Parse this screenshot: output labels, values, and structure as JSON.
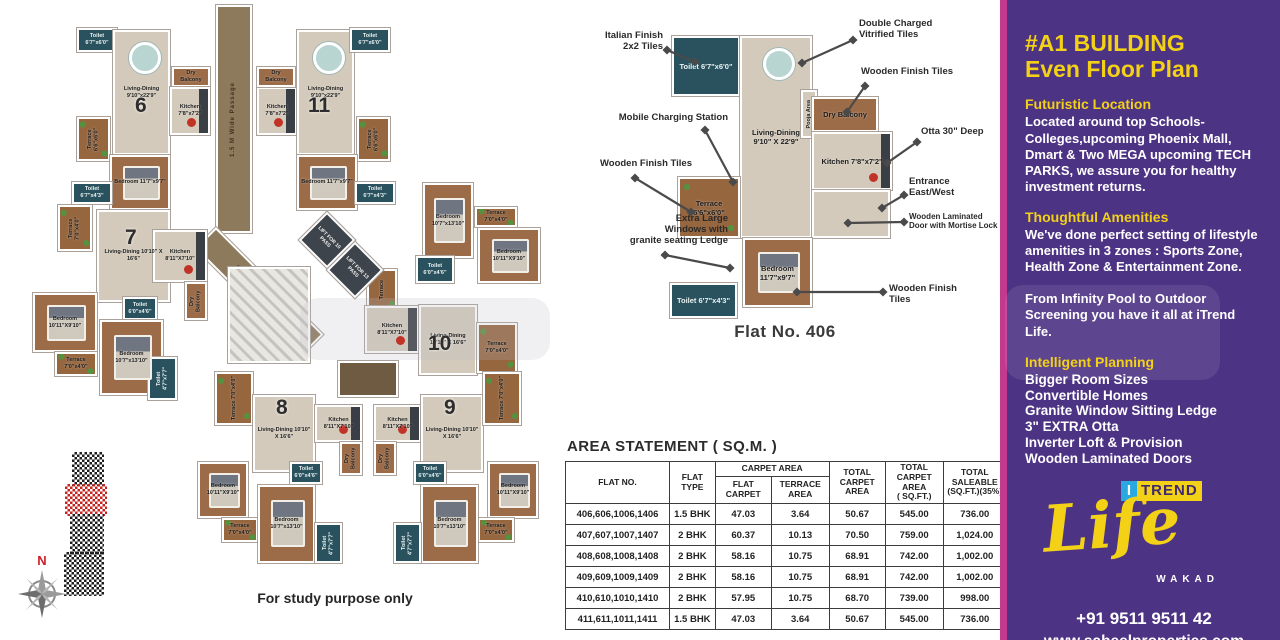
{
  "left_plan": {
    "disclaimer": "For study purpose only",
    "compass_n": "N",
    "passages": [
      {
        "n": "passage-vertical",
        "l": "1.5 M Wide Passage",
        "x": 196,
        "y": 0,
        "w": 36,
        "h": 228,
        "vert": true
      },
      {
        "n": "passage-diagonal",
        "l": "2 M Wide Passage",
        "x": 196,
        "y": 222,
        "w": 152,
        "h": 30,
        "rot": 45
      }
    ],
    "lobby": {
      "n": "lift-lobby",
      "x": 318,
      "y": 356,
      "w": 60,
      "h": 36
    },
    "stairs": {
      "n": "stairs",
      "x": 208,
      "y": 262,
      "w": 82,
      "h": 96
    },
    "lifts": [
      {
        "n": "lift-10-pass",
        "l": "LIFT FOR 10 PASS",
        "x": 287,
        "y": 215,
        "w": 40,
        "h": 40
      },
      {
        "n": "lift-13-pass",
        "l": "LIFT FOR 13 PASS",
        "x": 315,
        "y": 245,
        "w": 40,
        "h": 40
      }
    ],
    "flat_numbers": [
      {
        "num": "6",
        "x": 115,
        "y": 90
      },
      {
        "num": "11",
        "x": 288,
        "y": 90
      },
      {
        "num": "7",
        "x": 105,
        "y": 222
      },
      {
        "num": "10",
        "x": 408,
        "y": 328
      },
      {
        "num": "8",
        "x": 256,
        "y": 392
      },
      {
        "num": "9",
        "x": 424,
        "y": 392
      }
    ],
    "rooms": [
      {
        "n": "f6-toilet-top",
        "t": "toilet",
        "l": "Toilet 6'7\"x6'0\"",
        "x": 57,
        "y": 23,
        "w": 40,
        "h": 24
      },
      {
        "n": "f6-living",
        "t": "floor",
        "l": "Living-Dining 9'10\"x22'9\"",
        "x": 93,
        "y": 25,
        "w": 57,
        "h": 125,
        "furn": "table"
      },
      {
        "n": "f6-dry-balcony",
        "t": "wood",
        "l": "Dry Balcony",
        "x": 152,
        "y": 62,
        "w": 38,
        "h": 20
      },
      {
        "n": "f6-kitchen",
        "t": "kitchen",
        "l": "Kitchen 7'8\"x7'2\"",
        "x": 150,
        "y": 82,
        "w": 40,
        "h": 48,
        "furn": "stove"
      },
      {
        "n": "f6-terrace",
        "t": "terr",
        "l": "Terrace 6'6\"x6'0\"",
        "x": 57,
        "y": 112,
        "w": 33,
        "h": 44,
        "vert": true
      },
      {
        "n": "f6-bedroom",
        "t": "wood",
        "l": "Bedroom 11'7\"x9'7\"",
        "x": 90,
        "y": 150,
        "w": 60,
        "h": 55,
        "furn": "bed"
      },
      {
        "n": "f6-toilet-bottom",
        "t": "toilet",
        "l": "Toilet 6'7\"x4'3\"",
        "x": 52,
        "y": 177,
        "w": 40,
        "h": 22
      },
      {
        "n": "f11-kitchen",
        "t": "kitchen",
        "l": "Kitchen 7'8\"x7'2\"",
        "x": 237,
        "y": 82,
        "w": 40,
        "h": 48,
        "furn": "stove"
      },
      {
        "n": "f11-dry-balcony",
        "t": "wood",
        "l": "Dry Balcony",
        "x": 237,
        "y": 62,
        "w": 38,
        "h": 20
      },
      {
        "n": "f11-living",
        "t": "floor",
        "l": "Living-Dining 9'10\"x22'9\"",
        "x": 277,
        "y": 25,
        "w": 57,
        "h": 125,
        "furn": "table"
      },
      {
        "n": "f11-toilet-top",
        "t": "toilet",
        "l": "Toilet 6'7\"x6'0\"",
        "x": 330,
        "y": 23,
        "w": 40,
        "h": 24
      },
      {
        "n": "f11-terrace",
        "t": "terr",
        "l": "Terrace 6'6\"x6'0\"",
        "x": 337,
        "y": 112,
        "w": 33,
        "h": 44,
        "vert": true
      },
      {
        "n": "f11-bedroom",
        "t": "wood",
        "l": "Bedroom 11'7\"x9'7\"",
        "x": 277,
        "y": 150,
        "w": 60,
        "h": 55,
        "furn": "bed"
      },
      {
        "n": "f11-toilet-bottom",
        "t": "toilet",
        "l": "Toilet 6'7\"x4'3\"",
        "x": 335,
        "y": 177,
        "w": 40,
        "h": 22
      },
      {
        "n": "f7-terrace-top",
        "t": "terr",
        "l": "Terrace 7'0\"x4'0\"",
        "x": 38,
        "y": 200,
        "w": 34,
        "h": 46,
        "vert": true
      },
      {
        "n": "f7-living",
        "t": "floor",
        "l": "Living-Dining 10'10\" X 16'6\"",
        "x": 77,
        "y": 205,
        "w": 73,
        "h": 92
      },
      {
        "n": "f7-kitchen",
        "t": "kitchen",
        "l": "Kitchen 8'11\"X7'10\"",
        "x": 133,
        "y": 225,
        "w": 54,
        "h": 52,
        "furn": "stove"
      },
      {
        "n": "f7-dry-balcony",
        "t": "wood",
        "l": "Dry Balcony",
        "x": 165,
        "y": 277,
        "w": 22,
        "h": 38,
        "vert": true
      },
      {
        "n": "f7-toilet-hall",
        "t": "toilet",
        "l": "Toilet 6'0\"x4'6\"",
        "x": 103,
        "y": 292,
        "w": 34,
        "h": 23
      },
      {
        "n": "f7-bedroom-left",
        "t": "wood",
        "l": "Bedroom 10'11\"X9'10\"",
        "x": 13,
        "y": 288,
        "w": 64,
        "h": 59,
        "furn": "bed"
      },
      {
        "n": "f7-terrace-left",
        "t": "terr",
        "l": "Terrace 7'0\"x4'0\"",
        "x": 35,
        "y": 347,
        "w": 42,
        "h": 24
      },
      {
        "n": "f7-bedroom-bottom",
        "t": "wood",
        "l": "Bedroom 10'7\"x13'10\"",
        "x": 80,
        "y": 315,
        "w": 63,
        "h": 75,
        "furn": "bed"
      },
      {
        "n": "f7-toilet-bottom",
        "t": "toilet",
        "l": "Toilet 4'7\"x7'7\"",
        "x": 128,
        "y": 352,
        "w": 29,
        "h": 43,
        "vert": true
      },
      {
        "n": "f10-bedroom-top",
        "t": "wood",
        "l": "Bedroom 10'7\"x13'10\"",
        "x": 403,
        "y": 178,
        "w": 50,
        "h": 75,
        "furn": "bed"
      },
      {
        "n": "f10-terrace-right",
        "t": "terr",
        "l": "Terrace 7'0\"x4'0\"",
        "x": 455,
        "y": 202,
        "w": 42,
        "h": 20
      },
      {
        "n": "f10-bedroom-right",
        "t": "wood",
        "l": "Bedroom 10'11\"X9'10\"",
        "x": 458,
        "y": 223,
        "w": 62,
        "h": 55,
        "furn": "bed"
      },
      {
        "n": "f10-toilet",
        "t": "toilet",
        "l": "Toilet 6'0\"x4'6\"",
        "x": 396,
        "y": 251,
        "w": 38,
        "h": 27
      },
      {
        "n": "f10-terrace-left",
        "t": "terr",
        "l": "Terrace",
        "x": 347,
        "y": 264,
        "w": 30,
        "h": 42,
        "vert": true
      },
      {
        "n": "f10-kitchen",
        "t": "kitchen",
        "l": "Kitchen 8'11\"X7'10\"",
        "x": 345,
        "y": 301,
        "w": 54,
        "h": 47,
        "furn": "stove"
      },
      {
        "n": "f10-living",
        "t": "floor",
        "l": "Living-Dining 10'10\" X 16'6\"",
        "x": 399,
        "y": 300,
        "w": 58,
        "h": 70
      },
      {
        "n": "f10-terrace-bottom",
        "t": "terr",
        "l": "Terrace 7'0\"x4'0\"",
        "x": 457,
        "y": 318,
        "w": 40,
        "h": 50
      },
      {
        "n": "f8-terrace-top",
        "t": "terr",
        "l": "Terrace 7'0\"x4'0\"",
        "x": 195,
        "y": 367,
        "w": 38,
        "h": 53,
        "vert": true
      },
      {
        "n": "f8-living",
        "t": "floor",
        "l": "Living-Dining 10'10\" X 16'6\"",
        "x": 233,
        "y": 390,
        "w": 62,
        "h": 77
      },
      {
        "n": "f8-kitchen",
        "t": "kitchen",
        "l": "Kitchen 8'11\"X7'10\"",
        "x": 295,
        "y": 400,
        "w": 47,
        "h": 37,
        "furn": "stove"
      },
      {
        "n": "f8-dry-balcony",
        "t": "wood",
        "l": "Dry Balcony",
        "x": 320,
        "y": 437,
        "w": 22,
        "h": 33,
        "vert": true
      },
      {
        "n": "f8-toilet-hall",
        "t": "toilet",
        "l": "Toilet 6'0\"x4'6\"",
        "x": 270,
        "y": 457,
        "w": 32,
        "h": 22
      },
      {
        "n": "f8-bedroom-left",
        "t": "wood",
        "l": "Bedroom 10'11\"X9'10\"",
        "x": 178,
        "y": 457,
        "w": 50,
        "h": 56,
        "furn": "bed"
      },
      {
        "n": "f8-terrace-bottom",
        "t": "terr",
        "l": "Terrace 7'0\"x4'0\"",
        "x": 202,
        "y": 513,
        "w": 36,
        "h": 24
      },
      {
        "n": "f8-bedroom-bottom",
        "t": "wood",
        "l": "Bedroom 10'7\"x13'10\"",
        "x": 238,
        "y": 480,
        "w": 57,
        "h": 78,
        "furn": "bed"
      },
      {
        "n": "f8-toilet-bottom",
        "t": "toilet",
        "l": "Toilet 4'7\"x7'7\"",
        "x": 295,
        "y": 518,
        "w": 27,
        "h": 40,
        "vert": true
      },
      {
        "n": "f9-kitchen",
        "t": "kitchen",
        "l": "Kitchen 8'11\"X7'10\"",
        "x": 354,
        "y": 400,
        "w": 47,
        "h": 37,
        "furn": "stove"
      },
      {
        "n": "f9-dry-balcony",
        "t": "wood",
        "l": "Dry Balcony",
        "x": 354,
        "y": 437,
        "w": 22,
        "h": 33,
        "vert": true
      },
      {
        "n": "f9-living",
        "t": "floor",
        "l": "Living-Dining 10'10\" X 16'6\"",
        "x": 401,
        "y": 390,
        "w": 62,
        "h": 77
      },
      {
        "n": "f9-terrace-top",
        "t": "terr",
        "l": "Terrace 7'0\"x4'0\"",
        "x": 463,
        "y": 367,
        "w": 38,
        "h": 53,
        "vert": true
      },
      {
        "n": "f9-toilet-hall",
        "t": "toilet",
        "l": "Toilet 6'0\"x4'6\"",
        "x": 394,
        "y": 457,
        "w": 32,
        "h": 22
      },
      {
        "n": "f9-bedroom-right",
        "t": "wood",
        "l": "Bedroom 10'11\"X9'10\"",
        "x": 468,
        "y": 457,
        "w": 50,
        "h": 56,
        "furn": "bed"
      },
      {
        "n": "f9-terrace-bottom",
        "t": "terr",
        "l": "Terrace 7'0\"x4'0\"",
        "x": 458,
        "y": 513,
        "w": 36,
        "h": 24
      },
      {
        "n": "f9-bedroom-bottom",
        "t": "wood",
        "l": "Bedroom 10'7\"x13'10\"",
        "x": 401,
        "y": 480,
        "w": 57,
        "h": 78,
        "furn": "bed"
      },
      {
        "n": "f9-toilet-bottom",
        "t": "toilet",
        "l": "Toilet 4'7\"x7'7\"",
        "x": 374,
        "y": 518,
        "w": 27,
        "h": 40,
        "vert": true
      }
    ]
  },
  "detail_plan": {
    "caption": "Flat No. 406",
    "rooms": [
      {
        "n": "d-toilet-top",
        "t": "toilet",
        "l": "Toilet 6'7\"x6'0\"",
        "x": 107,
        "y": 36,
        "w": 68,
        "h": 60,
        "big": true
      },
      {
        "n": "d-living",
        "t": "floor",
        "l": "Living-Dining 9'10\" X 22'9\"",
        "x": 175,
        "y": 36,
        "w": 72,
        "h": 202,
        "big": true,
        "furn": "table"
      },
      {
        "n": "d-pooja",
        "t": "floor",
        "l": "Pooja Area",
        "x": 236,
        "y": 90,
        "w": 16,
        "h": 48,
        "vert": true
      },
      {
        "n": "d-dry-balcony",
        "t": "wood",
        "l": "Dry Balcony",
        "x": 247,
        "y": 97,
        "w": 66,
        "h": 35,
        "big": true
      },
      {
        "n": "d-kitchen",
        "t": "kitchen",
        "l": "Kitchen 7'8\"x7'2\"",
        "x": 247,
        "y": 132,
        "w": 80,
        "h": 58,
        "big": true,
        "furn": "stove"
      },
      {
        "n": "d-entry-hall",
        "t": "floor",
        "l": "",
        "x": 247,
        "y": 190,
        "w": 78,
        "h": 48
      },
      {
        "n": "d-terrace",
        "t": "terr",
        "l": "Terrace 6'6\"x6'0\"",
        "x": 113,
        "y": 177,
        "w": 62,
        "h": 61,
        "big": true
      },
      {
        "n": "d-bedroom",
        "t": "wood",
        "l": "Bedroom 11'7\"x9'7\"",
        "x": 178,
        "y": 238,
        "w": 69,
        "h": 69,
        "big": true,
        "furn": "bed"
      },
      {
        "n": "d-toilet-bottom",
        "t": "toilet",
        "l": "Toilet 6'7\"x4'3\"",
        "x": 105,
        "y": 283,
        "w": 67,
        "h": 35,
        "big": true
      }
    ],
    "annotations": [
      {
        "text": "Italian Finish\n2x2 Tiles",
        "side": "L",
        "bx": 18,
        "by": 30,
        "bw": 80,
        "ax": 102,
        "ay": 50,
        "tx": 130,
        "ty": 62
      },
      {
        "text": "Mobile Charging Station",
        "side": "L",
        "bx": 38,
        "by": 112,
        "bw": 125,
        "ax": 140,
        "ay": 130,
        "tx": 168,
        "ty": 182
      },
      {
        "text": "Wooden Finish Tiles",
        "side": "L",
        "bx": 15,
        "by": 158,
        "bw": 112,
        "ax": 70,
        "ay": 178,
        "tx": 126,
        "ty": 212
      },
      {
        "text": "Extra Large\nWindows with\ngranite seating Ledge",
        "side": "L",
        "bx": 15,
        "by": 213,
        "bw": 148,
        "ax": 100,
        "ay": 255,
        "tx": 165,
        "ty": 268
      },
      {
        "text": "Double Charged\nVitrified Tiles",
        "side": "R",
        "bx": 294,
        "by": 18,
        "bw": 120,
        "ax": 288,
        "ay": 40,
        "tx": 237,
        "ty": 63
      },
      {
        "text": "Wooden Finish Tiles",
        "side": "R",
        "bx": 296,
        "by": 66,
        "bw": 130,
        "ax": 300,
        "ay": 86,
        "tx": 282,
        "ty": 112
      },
      {
        "text": "Otta 30\" Deep",
        "side": "R",
        "bx": 356,
        "by": 126,
        "bw": 95,
        "ax": 352,
        "ay": 142,
        "tx": 322,
        "ty": 163
      },
      {
        "text": "Entrance\nEast/West",
        "side": "R",
        "bx": 344,
        "by": 176,
        "bw": 80,
        "ax": 339,
        "ay": 195,
        "tx": 317,
        "ty": 208
      },
      {
        "text": "Wooden Laminated\nDoor with Mortise Lock",
        "side": "R",
        "bx": 344,
        "by": 212,
        "bw": 112,
        "small": true,
        "ax": 339,
        "ay": 222,
        "tx": 283,
        "ty": 223
      },
      {
        "text": "Wooden Finish\nTiles",
        "side": "R",
        "bx": 324,
        "by": 283,
        "bw": 90,
        "ax": 318,
        "ay": 292,
        "tx": 232,
        "ty": 292
      }
    ]
  },
  "area_table": {
    "title": "AREA STATEMENT ( SQ.M. )",
    "h_flat_no": "FLAT NO.",
    "h_flat_type": "FLAT\nTYPE",
    "h_carpet_group": "CARPET AREA",
    "h_flat_carpet": "FLAT\nCARPET",
    "h_terrace": "TERRACE\nAREA",
    "h_total_carpet": "TOTAL\nCARPET\nAREA",
    "h_total_sqft": "TOTAL\nCARPET\nAREA\n( SQ.FT.)",
    "h_saleable": "TOTAL\nSALEABLE\n(SQ.FT.)(35%)",
    "rows": [
      [
        "406,606,1006,1406",
        "1.5 BHK",
        "47.03",
        "3.64",
        "50.67",
        "545.00",
        "736.00"
      ],
      [
        "407,607,1007,1407",
        "2 BHK",
        "60.37",
        "10.13",
        "70.50",
        "759.00",
        "1,024.00"
      ],
      [
        "408,608,1008,1408",
        "2 BHK",
        "58.16",
        "10.75",
        "68.91",
        "742.00",
        "1,002.00"
      ],
      [
        "409,609,1009,1409",
        "2 BHK",
        "58.16",
        "10.75",
        "68.91",
        "742.00",
        "1,002.00"
      ],
      [
        "410,610,1010,1410",
        "2 BHK",
        "57.95",
        "10.75",
        "68.70",
        "739.00",
        "998.00"
      ],
      [
        "411,611,1011,1411",
        "1.5 BHK",
        "47.03",
        "3.64",
        "50.67",
        "545.00",
        "736.00"
      ]
    ]
  },
  "sidebar": {
    "accent_pink": "#c23a8e",
    "bg_purple": "#4d3384",
    "accent_yellow": "#f2d117",
    "title_line1": "#A1 BUILDING",
    "title_line2": "Even Floor Plan",
    "s1_head": "Futuristic Location",
    "s1_body": "Located around top Schools-Colleges,upcoming Phoenix Mall, Dmart & Two MEGA upcoming TECH PARKS, we assure you for healthy investment returns.",
    "s2_head": "Thoughtful Amenities",
    "s2_body": "We've done perfect setting of lifestyle amenities in 3 zones : Sports Zone, Health Zone & Entertainment Zone.",
    "s3_body": "From Infinity Pool to Outdoor Screening you have it all at iTrend Life.",
    "s4_head": "Intelligent Planning",
    "s4_items": [
      "Bigger Room Sizes",
      "Convertible Homes",
      "Granite Window Sitting Ledge",
      "3\" EXTRA Otta",
      "Inverter Loft & Provision",
      "Wooden Laminated Doors"
    ],
    "logo_i": "I",
    "logo_trend": "TREND",
    "logo_life": "Life",
    "logo_city": "WAKAD",
    "phone": "+91 9511 9511 42",
    "website": "www.saheelproperties.com"
  }
}
